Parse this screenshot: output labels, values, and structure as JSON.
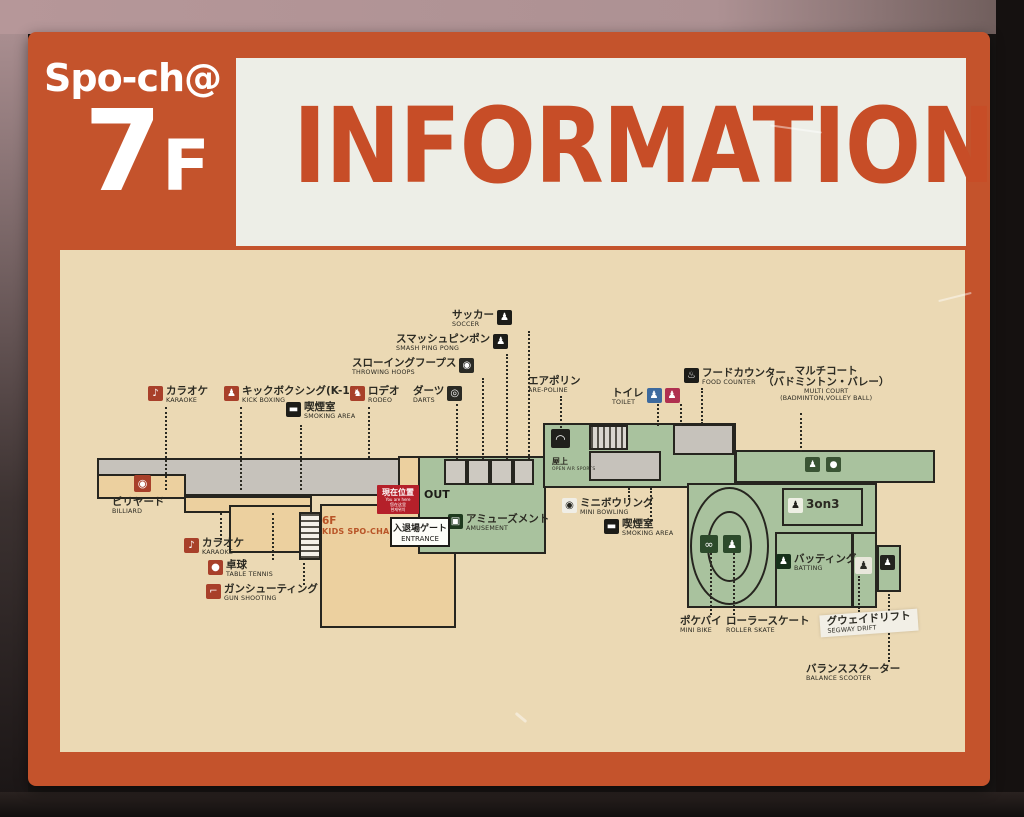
{
  "sign": {
    "brand": "Spo-ch@",
    "floor_big": "7",
    "floor_small": "F",
    "title": "INFORMATION"
  },
  "colors": {
    "sign_orange": "#c4532c",
    "title_orange": "#c74d27",
    "panel_white": "#edeee7",
    "map_cream": "#ebd9b4",
    "zone_tan": "#ecd09f",
    "zone_green": "#a9c29e",
    "zone_gray": "#c6c2bb",
    "outline": "#26251f",
    "badge_red": "#b5202a"
  },
  "you_are_here": {
    "jp": "現在位置",
    "small_lines": [
      "You are here",
      "您在这里",
      "현재위치"
    ]
  },
  "out_label": "OUT",
  "entrance": {
    "jp": "入退場ゲート",
    "en": "ENTRANCE"
  },
  "labels": [
    {
      "name": "karaoke-upper",
      "jp": "カラオケ",
      "en": "KARAOKE",
      "x": 148,
      "y": 386,
      "icon": {
        "side": "left",
        "bg": "#a8402a",
        "fg": "#ffffff",
        "g": "♪"
      }
    },
    {
      "name": "kick-boxing",
      "jp": "キックボクシング(K-1)",
      "en": "KICK BOXING",
      "x": 224,
      "y": 386,
      "icon": {
        "side": "left",
        "bg": "#a8402a",
        "fg": "#ffffff",
        "g": "♟"
      }
    },
    {
      "name": "smoking-left",
      "jp": "喫煙室",
      "en": "SMOKING AREA",
      "x": 286,
      "y": 402,
      "icon": {
        "side": "left",
        "bg": "#1c1c18",
        "fg": "#ffffff",
        "g": "▬"
      }
    },
    {
      "name": "rodeo",
      "jp": "ロデオ",
      "en": "RODEO",
      "x": 350,
      "y": 386,
      "icon": {
        "side": "left",
        "bg": "#a8402a",
        "fg": "#ffffff",
        "g": "♞"
      }
    },
    {
      "name": "darts",
      "jp": "ダーツ",
      "en": "DARTS",
      "x": 413,
      "y": 386,
      "icon": {
        "side": "right",
        "bg": "#2a2a24",
        "fg": "#ffffff",
        "g": "◎"
      }
    },
    {
      "name": "throwing-hoops",
      "jp": "スローイングフープス",
      "en": "THROWING HOOPS",
      "x": 352,
      "y": 358,
      "icon": {
        "side": "right",
        "bg": "#2a2a24",
        "fg": "#ffffff",
        "g": "◉"
      }
    },
    {
      "name": "smash-ping-pong",
      "jp": "スマッシュピンポン",
      "en": "SMASH PING PONG",
      "x": 396,
      "y": 334,
      "icon": {
        "side": "right",
        "bg": "#1c1c18",
        "fg": "#ffffff",
        "g": "♟"
      }
    },
    {
      "name": "soccer",
      "jp": "サッカー",
      "en": "SOCCER",
      "x": 452,
      "y": 310,
      "icon": {
        "side": "right",
        "bg": "#1c1c18",
        "fg": "#ffffff",
        "g": "♟"
      }
    },
    {
      "name": "are-poline",
      "jp": "エアポリン",
      "en": "ARE-POLINE",
      "x": 528,
      "y": 376
    },
    {
      "name": "toilet",
      "jp": "トイレ",
      "en": "TOILET",
      "x": 612,
      "y": 388,
      "icons": [
        {
          "bg": "#3d6a9e",
          "fg": "#ffffff",
          "g": "♟"
        },
        {
          "bg": "#b03050",
          "fg": "#ffffff",
          "g": "♟"
        }
      ]
    },
    {
      "name": "food-counter",
      "jp": "フードカウンター",
      "en": "FOOD COUNTER",
      "x": 684,
      "y": 368,
      "icon": {
        "side": "left",
        "bg": "#1c1c18",
        "fg": "#ffffff",
        "g": "♨"
      }
    },
    {
      "name": "multi-court",
      "jp": "マルチコート",
      "jp2": "（バドミントン・バレー）",
      "en": "MULTI COURT",
      "en2": "(BADMINTON,VOLLEY BALL)",
      "x": 763,
      "y": 366,
      "center": true
    },
    {
      "name": "billiard",
      "jp": "ビリヤード",
      "en": "BILLIARD",
      "x": 112,
      "y": 497
    },
    {
      "name": "karaoke-lower",
      "jp": "カラオケ",
      "en": "KARAOKE",
      "x": 184,
      "y": 538,
      "icon": {
        "side": "left",
        "bg": "#a8402a",
        "fg": "#ffffff",
        "g": "♪"
      }
    },
    {
      "name": "table-tennis",
      "jp": "卓球",
      "en": "TABLE TENNIS",
      "x": 208,
      "y": 560,
      "icon": {
        "side": "left",
        "bg": "#a8402a",
        "fg": "#ffffff",
        "g": "●"
      }
    },
    {
      "name": "gun-shooting",
      "jp": "ガンシューティング",
      "en": "GUN SHOOTING",
      "x": 206,
      "y": 584,
      "icon": {
        "side": "left",
        "bg": "#a8402a",
        "fg": "#ffffff",
        "g": "⌐"
      }
    },
    {
      "name": "kids-spocha",
      "jp": "6F",
      "en": "KIDS SPO-CHA",
      "x": 322,
      "y": 516,
      "orange": true
    },
    {
      "name": "rooftop",
      "jp": "屋上",
      "en": "OPEN AIR SPORTS",
      "x": 552,
      "y": 458,
      "tiny": true
    },
    {
      "name": "amusement",
      "jp": "アミューズメント",
      "en": "AMUSEMENT",
      "x": 448,
      "y": 514,
      "icon": {
        "side": "left",
        "bg": "#1e3a1e",
        "fg": "#ffffff",
        "g": "▣"
      }
    },
    {
      "name": "mini-bowling",
      "jp": "ミニボウリング",
      "en": "MINI BOWLING",
      "x": 562,
      "y": 498,
      "icon": {
        "side": "left",
        "bg": "#f0eee6",
        "fg": "#23231e",
        "g": "◉"
      }
    },
    {
      "name": "smoking-right",
      "jp": "喫煙室",
      "en": "SMOKING AREA",
      "x": 604,
      "y": 519,
      "icon": {
        "side": "left",
        "bg": "#1c1c18",
        "fg": "#ffffff",
        "g": "▬"
      }
    },
    {
      "name": "three-on-three",
      "jp": "3on3",
      "en": "",
      "x": 788,
      "y": 498,
      "big3": true,
      "icon": {
        "side": "left",
        "bg": "#eef0e4",
        "fg": "#23231e",
        "g": "♟"
      }
    },
    {
      "name": "batting",
      "jp": "バッティング",
      "en": "BATTING",
      "x": 776,
      "y": 554,
      "icon": {
        "side": "left",
        "bg": "#16301a",
        "fg": "#ffffff",
        "g": "♟"
      }
    },
    {
      "name": "mini-bike",
      "jp": "ポケバイ",
      "en": "MINI BIKE",
      "x": 680,
      "y": 616
    },
    {
      "name": "roller-skate",
      "jp": "ローラースケート",
      "en": "ROLLER SKATE",
      "x": 726,
      "y": 616
    },
    {
      "name": "segway-drift",
      "jp": "グウェイドリフト",
      "en": "SEGWAY DRIFT",
      "x": 820,
      "y": 612,
      "sticker": true
    },
    {
      "name": "balance-scooter",
      "jp": "バランススクーター",
      "en": "BALANCE SCOOTER",
      "x": 806,
      "y": 664
    }
  ],
  "map": {
    "outline": "#26251f",
    "zones": [
      {
        "name": "zone-left-corridor",
        "x": 97,
        "y": 458,
        "w": 323,
        "h": 38,
        "fill": "#c6c2bb"
      },
      {
        "name": "zone-billiard",
        "x": 97,
        "y": 474,
        "w": 89,
        "h": 25,
        "fill": "#ecd09f"
      },
      {
        "name": "zone-tan-strip",
        "x": 184,
        "y": 496,
        "w": 128,
        "h": 17,
        "fill": "#ecd09f"
      },
      {
        "name": "zone-karaoke-block",
        "x": 229,
        "y": 505,
        "w": 83,
        "h": 48,
        "fill": "#ecd09f"
      },
      {
        "name": "zone-entrance-corridor",
        "x": 398,
        "y": 456,
        "w": 31,
        "h": 56,
        "fill": "#ecd09f"
      },
      {
        "name": "zone-kids-spocha",
        "x": 320,
        "y": 504,
        "w": 136,
        "h": 124,
        "fill": "#ecd09f",
        "xcross": true
      },
      {
        "name": "zone-stairs-left",
        "x": 299,
        "y": 512,
        "w": 22,
        "h": 48,
        "hatch": "H"
      },
      {
        "name": "zone-amusement",
        "x": 418,
        "y": 456,
        "w": 128,
        "h": 98,
        "fill": "#a9c29e"
      },
      {
        "name": "zone-booth-1",
        "x": 444,
        "y": 459,
        "w": 23,
        "h": 26,
        "fill": "#cdc9c1"
      },
      {
        "name": "zone-booth-2",
        "x": 467,
        "y": 459,
        "w": 23,
        "h": 26,
        "fill": "#cdc9c1"
      },
      {
        "name": "zone-booth-3",
        "x": 490,
        "y": 459,
        "w": 23,
        "h": 26,
        "fill": "#cdc9c1"
      },
      {
        "name": "zone-booth-4",
        "x": 513,
        "y": 459,
        "w": 21,
        "h": 26,
        "fill": "#cdc9c1"
      },
      {
        "name": "zone-upper-corridor",
        "x": 543,
        "y": 423,
        "w": 193,
        "h": 65,
        "fill": "#a9c29e"
      },
      {
        "name": "zone-stairs-right",
        "x": 589,
        "y": 425,
        "w": 39,
        "h": 25,
        "hatch": "V"
      },
      {
        "name": "zone-gray-hall",
        "x": 589,
        "y": 451,
        "w": 72,
        "h": 30,
        "fill": "#c6c2bb"
      },
      {
        "name": "zone-food-counter",
        "x": 673,
        "y": 424,
        "w": 61,
        "h": 31,
        "fill": "#c6c2bb"
      },
      {
        "name": "zone-multi-court",
        "x": 735,
        "y": 450,
        "w": 200,
        "h": 33,
        "fill": "#a9c29e"
      },
      {
        "name": "zone-main-right",
        "x": 687,
        "y": 483,
        "w": 190,
        "h": 125,
        "fill": "#a9c29e"
      },
      {
        "name": "zone-right-col-a",
        "x": 852,
        "y": 532,
        "w": 25,
        "h": 76,
        "fill": "transparent"
      },
      {
        "name": "zone-right-col-b",
        "x": 877,
        "y": 545,
        "w": 24,
        "h": 47,
        "fill": "#a9c29e"
      },
      {
        "name": "zone-track-outer",
        "x": 690,
        "y": 487,
        "w": 79,
        "h": 118,
        "fill": "transparent",
        "round": true
      },
      {
        "name": "zone-track-inner",
        "x": 707,
        "y": 511,
        "w": 45,
        "h": 71,
        "fill": "transparent",
        "round": true
      },
      {
        "name": "zone-3on3-court",
        "x": 782,
        "y": 488,
        "w": 81,
        "h": 38,
        "fill": "transparent"
      },
      {
        "name": "zone-batting-cage",
        "x": 775,
        "y": 532,
        "w": 78,
        "h": 76,
        "fill": "transparent"
      }
    ],
    "icons": [
      {
        "name": "billiard-icon",
        "x": 134,
        "y": 475,
        "s": 17,
        "bg": "#a8402a",
        "fg": "#ffffff",
        "g": "◉"
      },
      {
        "name": "trampoline-icon",
        "x": 551,
        "y": 429,
        "s": 19,
        "bg": "#20201c",
        "fg": "#ffffff",
        "g": "◠"
      },
      {
        "name": "badminton-icon",
        "x": 805,
        "y": 457,
        "s": 15,
        "bg": "#3a5434",
        "fg": "#ffffff",
        "g": "♟"
      },
      {
        "name": "volleyball-icon",
        "x": 826,
        "y": 457,
        "s": 15,
        "bg": "#3a5434",
        "fg": "#ffffff",
        "g": "●"
      },
      {
        "name": "mini-bike-icon",
        "x": 700,
        "y": 535,
        "s": 18,
        "bg": "#2c4a2b",
        "fg": "#ffffff",
        "g": "∞"
      },
      {
        "name": "roller-skate-icon",
        "x": 723,
        "y": 535,
        "s": 18,
        "bg": "#2c4a2b",
        "fg": "#ffffff",
        "g": "♟"
      },
      {
        "name": "segway-icon",
        "x": 855,
        "y": 557,
        "s": 17,
        "bg": "#e9e7db",
        "fg": "#2a2a24",
        "g": "♟"
      },
      {
        "name": "balance-icon",
        "x": 880,
        "y": 555,
        "s": 15,
        "bg": "#22221e",
        "fg": "#ffffff",
        "g": "♟"
      }
    ],
    "leaders": [
      {
        "x": 165,
        "y1": 407,
        "y2": 490
      },
      {
        "x": 240,
        "y1": 407,
        "y2": 490
      },
      {
        "x": 300,
        "y1": 425,
        "y2": 490
      },
      {
        "x": 368,
        "y1": 407,
        "y2": 458
      },
      {
        "x": 456,
        "y1": 404,
        "y2": 459
      },
      {
        "x": 482,
        "y1": 378,
        "y2": 459
      },
      {
        "x": 506,
        "y1": 354,
        "y2": 459
      },
      {
        "x": 528,
        "y1": 331,
        "y2": 459
      },
      {
        "x": 560,
        "y1": 396,
        "y2": 428
      },
      {
        "x": 657,
        "y1": 404,
        "y2": 426
      },
      {
        "x": 680,
        "y1": 404,
        "y2": 426
      },
      {
        "x": 701,
        "y1": 388,
        "y2": 424
      },
      {
        "x": 800,
        "y1": 413,
        "y2": 452
      },
      {
        "x": 220,
        "y1": 513,
        "y2": 540
      },
      {
        "x": 272,
        "y1": 513,
        "y2": 560
      },
      {
        "x": 303,
        "y1": 558,
        "y2": 585
      },
      {
        "x": 628,
        "y1": 488,
        "y2": 500
      },
      {
        "x": 650,
        "y1": 488,
        "y2": 521
      },
      {
        "x": 710,
        "y1": 553,
        "y2": 615
      },
      {
        "x": 733,
        "y1": 553,
        "y2": 615
      },
      {
        "x": 858,
        "y1": 576,
        "y2": 612
      },
      {
        "x": 888,
        "y1": 594,
        "y2": 662
      }
    ]
  }
}
